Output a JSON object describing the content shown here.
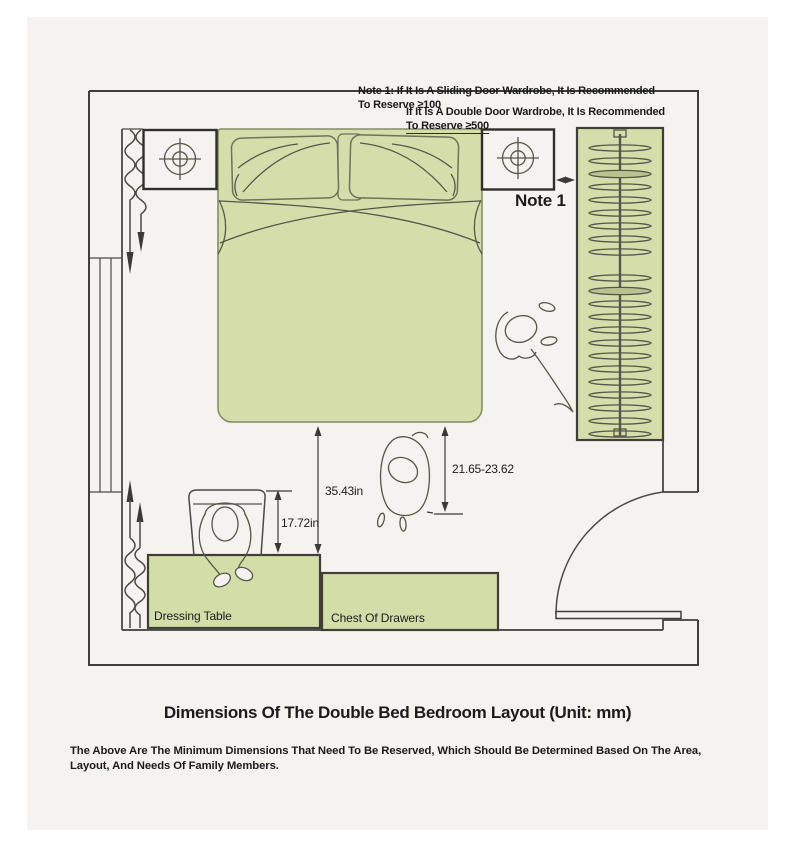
{
  "plan": {
    "notes": {
      "sliding": {
        "line1": "Note 1: If It Is A Sliding Door Wardrobe, It Is Recommended",
        "line2": "To Reserve ≥100"
      },
      "double_door": {
        "line1": "If It Is A Double Door Wardrobe, It Is Recommended",
        "line2": "To Reserve ≥500"
      },
      "marker": "Note 1"
    },
    "dimensions": {
      "bed_to_dressing_table": "35.43in",
      "chair_clearance": "17.72in",
      "side_walkway": "21.65-23.62"
    },
    "labels": {
      "dressing_table": "Dressing Table",
      "chest_of_drawers": "Chest Of Drawers"
    }
  },
  "footer": {
    "title": "Dimensions Of The Double Bed Bedroom Layout (Unit: mm)",
    "subtitle_line1": "The Above Are The Minimum Dimensions That Need To Be Reserved, Which Should Be Determined Based On The Area,",
    "subtitle_line2": "Layout, And Needs Of Family Members."
  },
  "colors": {
    "furniture_green": "#d5deab",
    "furniture_green_dark": "#b9c390",
    "panel_background": "#f4f3f0",
    "wall_line": "#3e3e3a",
    "text": "#1b1b1b"
  }
}
